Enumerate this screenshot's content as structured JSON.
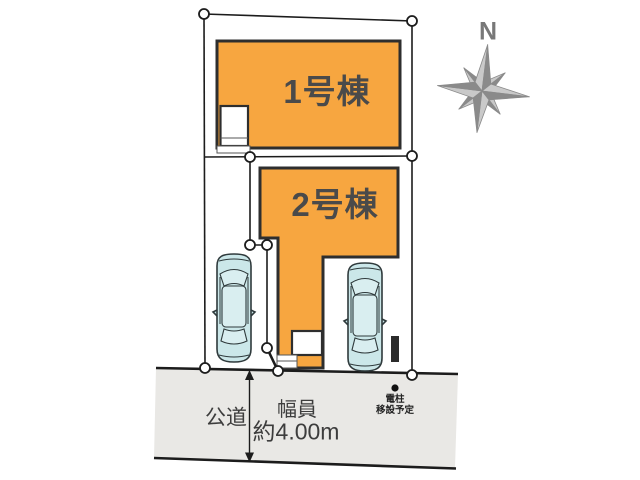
{
  "site_plan": {
    "buildings": [
      {
        "label": "1号棟"
      },
      {
        "label": "2号棟"
      }
    ],
    "road": {
      "label": "公道",
      "width_caption": "幅員",
      "width_value": "約4.00m"
    },
    "utility_pole": {
      "line1": "電柱",
      "line2": "移設予定"
    },
    "compass": {
      "north_label": "N"
    }
  },
  "colors": {
    "building_fill": "#F7A640",
    "building_border": "#2E2E2E",
    "car_fill": "#CBE7E9",
    "car_glass": "#D9EEF0",
    "car_stroke": "#2F3A3C",
    "road_fill": "#E9E8E5",
    "line_color": "#1C1C1C",
    "text_color": "#3D3D3D",
    "building_label_color": "#4A4A4A",
    "compass_dark": "#8A8A8A",
    "compass_light": "#C9C9C9",
    "pole_color": "#111111"
  }
}
